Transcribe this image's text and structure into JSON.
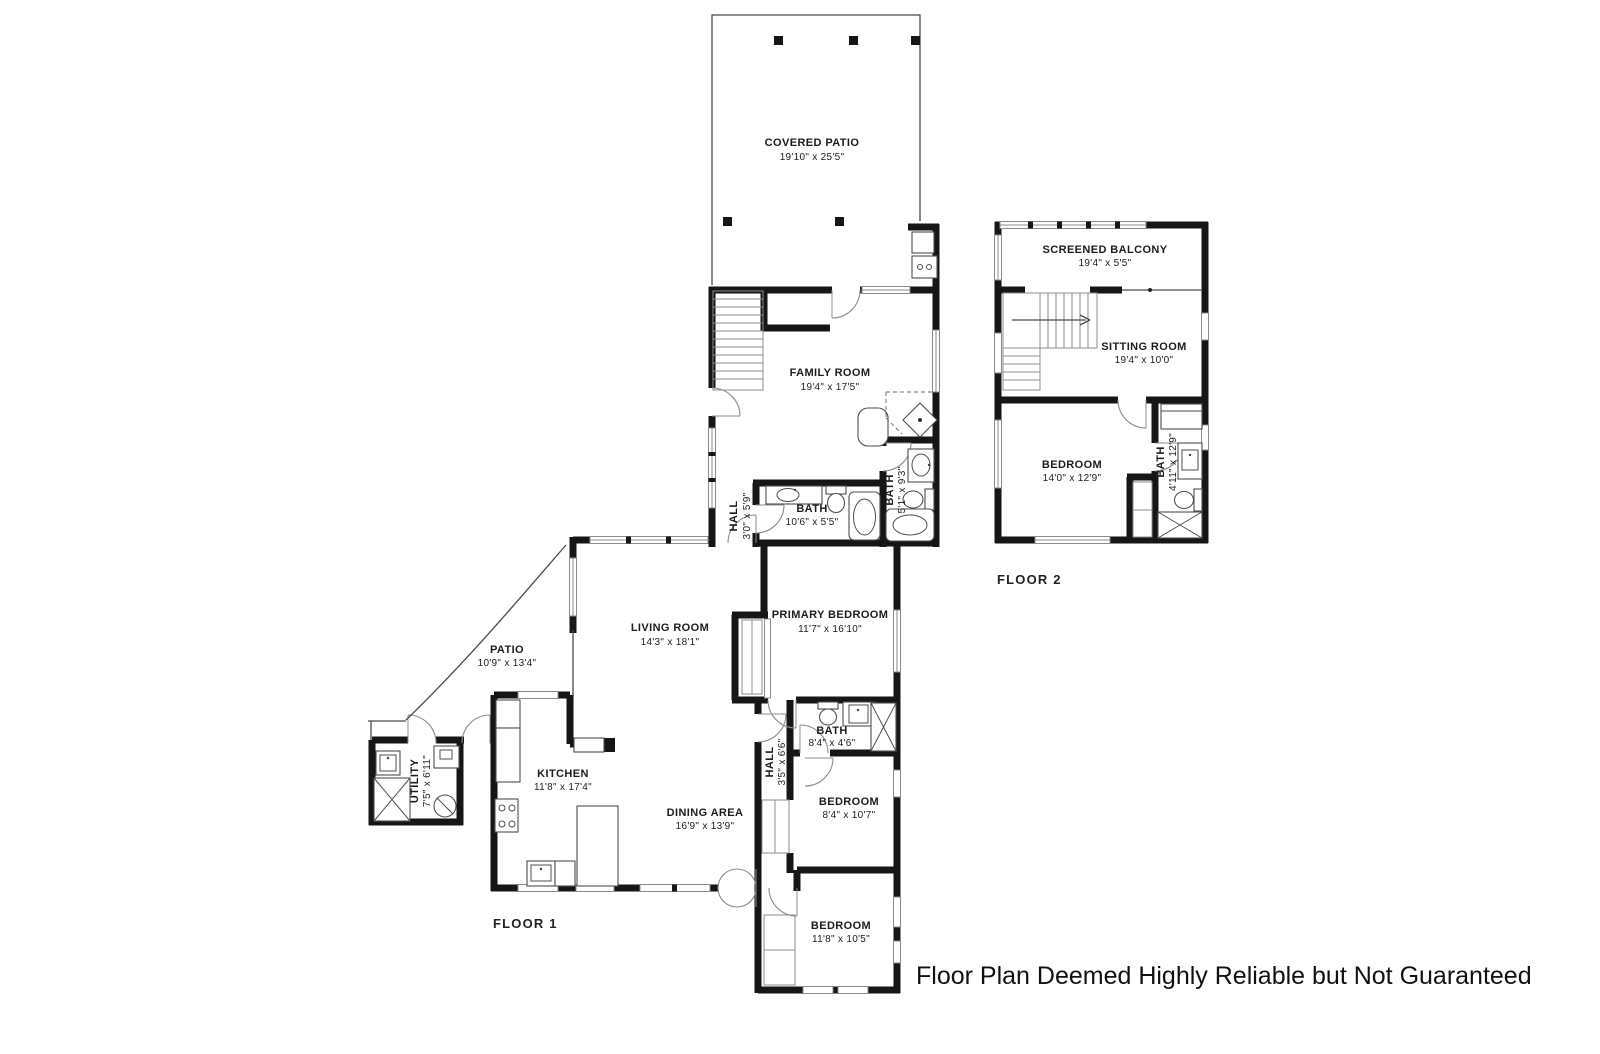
{
  "disclaimer": "Floor Plan Deemed Highly Reliable but Not Guaranteed",
  "floor_labels": {
    "floor1": "FLOOR 1",
    "floor2": "FLOOR 2"
  },
  "rooms": {
    "covered_patio": {
      "name": "COVERED PATIO",
      "dims": "19'10\" x 25'5\""
    },
    "family_room": {
      "name": "FAMILY ROOM",
      "dims": "19'4\" x 17'5\""
    },
    "hall1": {
      "name": "HALL",
      "dims": "3'0\" x 5'9\""
    },
    "bath_main": {
      "name": "BATH",
      "dims": "10'6\" x 5'5\""
    },
    "bath_family": {
      "name": "BATH",
      "dims": "5'1\" x 9'3\""
    },
    "living_room": {
      "name": "LIVING ROOM",
      "dims": "14'3\" x 18'1\""
    },
    "primary_bedroom": {
      "name": "PRIMARY BEDROOM",
      "dims": "11'7\" x 16'10\""
    },
    "patio": {
      "name": "PATIO",
      "dims": "10'9\" x 13'4\""
    },
    "utility": {
      "name": "UTILITY",
      "dims": "7'5\" x 6'11\""
    },
    "kitchen": {
      "name": "KITCHEN",
      "dims": "11'8\" x 17'4\""
    },
    "dining_area": {
      "name": "DINING AREA",
      "dims": "16'9\" x 13'9\""
    },
    "hall2": {
      "name": "HALL",
      "dims": "3'5\" x 6'6\""
    },
    "bath_hall": {
      "name": "BATH",
      "dims": "8'4\" x 4'6\""
    },
    "bedroom_mid": {
      "name": "BEDROOM",
      "dims": "8'4\" x 10'7\""
    },
    "bedroom_bottom": {
      "name": "BEDROOM",
      "dims": "11'8\" x 10'5\""
    },
    "screened_balcony": {
      "name": "SCREENED BALCONY",
      "dims": "19'4\" x 5'5\""
    },
    "sitting_room": {
      "name": "SITTING ROOM",
      "dims": "19'4\" x 10'0\""
    },
    "bedroom_f2": {
      "name": "BEDROOM",
      "dims": "14'0\" x 12'9\""
    },
    "bath_f2": {
      "name": "BATH",
      "dims": "4'11\" x 12'9\""
    }
  }
}
